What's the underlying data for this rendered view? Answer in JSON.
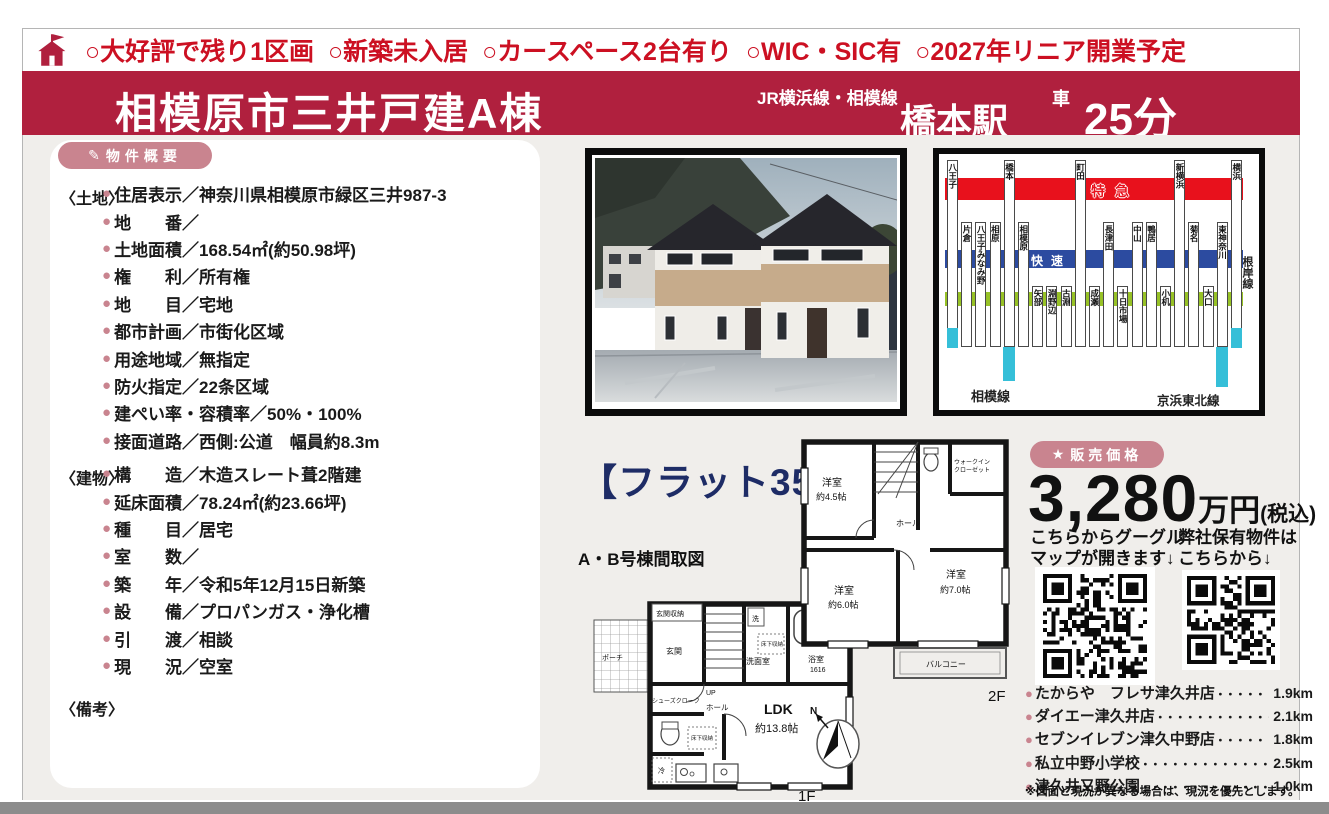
{
  "theme": {
    "accent_red": "#b0203e",
    "bright_red": "#cc1022",
    "pink": "#c9848f",
    "bg_gray": "#f0eeeb",
    "navy": "#1e2c66",
    "rail_red": "#e8111c",
    "rail_blue": "#2c4ba0",
    "rail_green": "#97c226",
    "rail_cyan": "#35bfd8"
  },
  "top_banner": {
    "items": [
      "○大好評で残り1区画",
      "○新築未入居",
      "○カースペース2台有り",
      "○WIC・SIC有",
      "○2027年リニア開業予定"
    ]
  },
  "title_bar": {
    "property_name": "相模原市三井戸建A棟",
    "line_label": "JR横浜線・相模線",
    "station": "橋本駅",
    "mode": "車",
    "time": "25分"
  },
  "overview": {
    "badge_icon": "✎",
    "badge": "物件概要",
    "land_label": "〈土地〉",
    "land_items": [
      "住居表示／神奈川県相模原市緑区三井987-3",
      "地　　番／",
      "土地面積／168.54㎡(約50.98坪)",
      "権　　利／所有権",
      "地　　目／宅地",
      "都市計画／市街化区域",
      "用途地域／無指定",
      "防火指定／22条区域",
      "建ぺい率・容積率／50%・100%",
      "接面道路／西側:公道　幅員約8.3m"
    ],
    "building_label": "〈建物〉",
    "building_items": [
      "構　　造／木造スレート葺2階建",
      "延床面積／78.24㎡(約23.66坪)",
      "種　　目／居宅",
      "室　　数／",
      "築　　年／令和5年12月15日新築",
      "設　　備／プロパンガス・浄化槽",
      "引　　渡／相談",
      "現　　況／空室"
    ],
    "remarks_label": "〈備考〉"
  },
  "flat35": {
    "main": "【フラット35】",
    "suffix": "対応",
    "caption": "A・B号棟間取図"
  },
  "floorplan": {
    "f1": {
      "genkan_storage": "玄関収納",
      "porch": "ポーチ",
      "genkan": "玄関",
      "shoes": "シューズクローク",
      "hall": "ホール",
      "up": "UP",
      "laundry": "洗",
      "wash": "洗面室",
      "underfloor": "床下収納",
      "bath": "浴室",
      "bath_size": "1616",
      "fridge": "冷",
      "ldk": "LDK",
      "ldk_size": "約13.8帖",
      "label": "1F"
    },
    "f2": {
      "room45": "洋室",
      "room45_size": "約4.5帖",
      "wic1": "ウォークイン",
      "wic2": "クローゼット",
      "hall": "ホール",
      "room60": "洋室",
      "room60_size": "約6.0帖",
      "room70": "洋室",
      "room70_size": "約7.0帖",
      "balcony": "バルコニー",
      "label": "2F"
    },
    "compass_n": "N"
  },
  "railmap": {
    "express_label": "特急",
    "rapid_label": "快速",
    "sagami_line": "相模線",
    "keihin_line": "京浜東北線",
    "negishi_line": "根岸線",
    "stations": [
      {
        "name": "八王子",
        "tier": 1,
        "cyan": true
      },
      {
        "name": "片倉",
        "tier": 2
      },
      {
        "name": "八王子みなみ野",
        "tier": 2
      },
      {
        "name": "相原",
        "tier": 2
      },
      {
        "name": "橋本",
        "tier": 1
      },
      {
        "name": "相模原",
        "tier": 2
      },
      {
        "name": "矢部",
        "tier": 3
      },
      {
        "name": "淵野辺",
        "tier": 3
      },
      {
        "name": "古淵",
        "tier": 3
      },
      {
        "name": "町田",
        "tier": 1
      },
      {
        "name": "成瀬",
        "tier": 3
      },
      {
        "name": "長津田",
        "tier": 2
      },
      {
        "name": "十日市場",
        "tier": 3
      },
      {
        "name": "中山",
        "tier": 2
      },
      {
        "name": "鴨居",
        "tier": 2
      },
      {
        "name": "小机",
        "tier": 3
      },
      {
        "name": "新横浜",
        "tier": 1
      },
      {
        "name": "菊名",
        "tier": 2
      },
      {
        "name": "大口",
        "tier": 3
      },
      {
        "name": "東神奈川",
        "tier": 2
      },
      {
        "name": "横浜",
        "tier": 1,
        "cyan": true
      }
    ]
  },
  "price": {
    "badge_icon": "★",
    "badge": "販売価格",
    "amount": "3,280",
    "unit": "万円",
    "tax": "(税込)",
    "qr_left_caption_1": "こちらからグーグル",
    "qr_left_caption_2": "マップが開きます↓",
    "qr_right_caption_1": "弊社保有物件は",
    "qr_right_caption_2": "こちらから↓"
  },
  "facilities": {
    "items": [
      {
        "name": "たからや　フレサ津久井店",
        "dots": "・・・・・・・・",
        "distance": "1.9km"
      },
      {
        "name": "ダイエー津久井店",
        "dots": "・・・・・・・・・・・・・・・",
        "distance": "2.1km"
      },
      {
        "name": "セブンイレブン津久中野店",
        "dots": "・・・・・・・・・",
        "distance": "1.8km"
      },
      {
        "name": "私立中野小学校",
        "dots": "・・・・・・・・・・・・・・・・",
        "distance": "2.5km"
      },
      {
        "name": "津久井又野公園",
        "dots": "・・・・・・・・・・・・・・",
        "distance": "1.0km"
      }
    ],
    "note": "※図面と現況が異なる場合は、現況を優先とします。"
  }
}
